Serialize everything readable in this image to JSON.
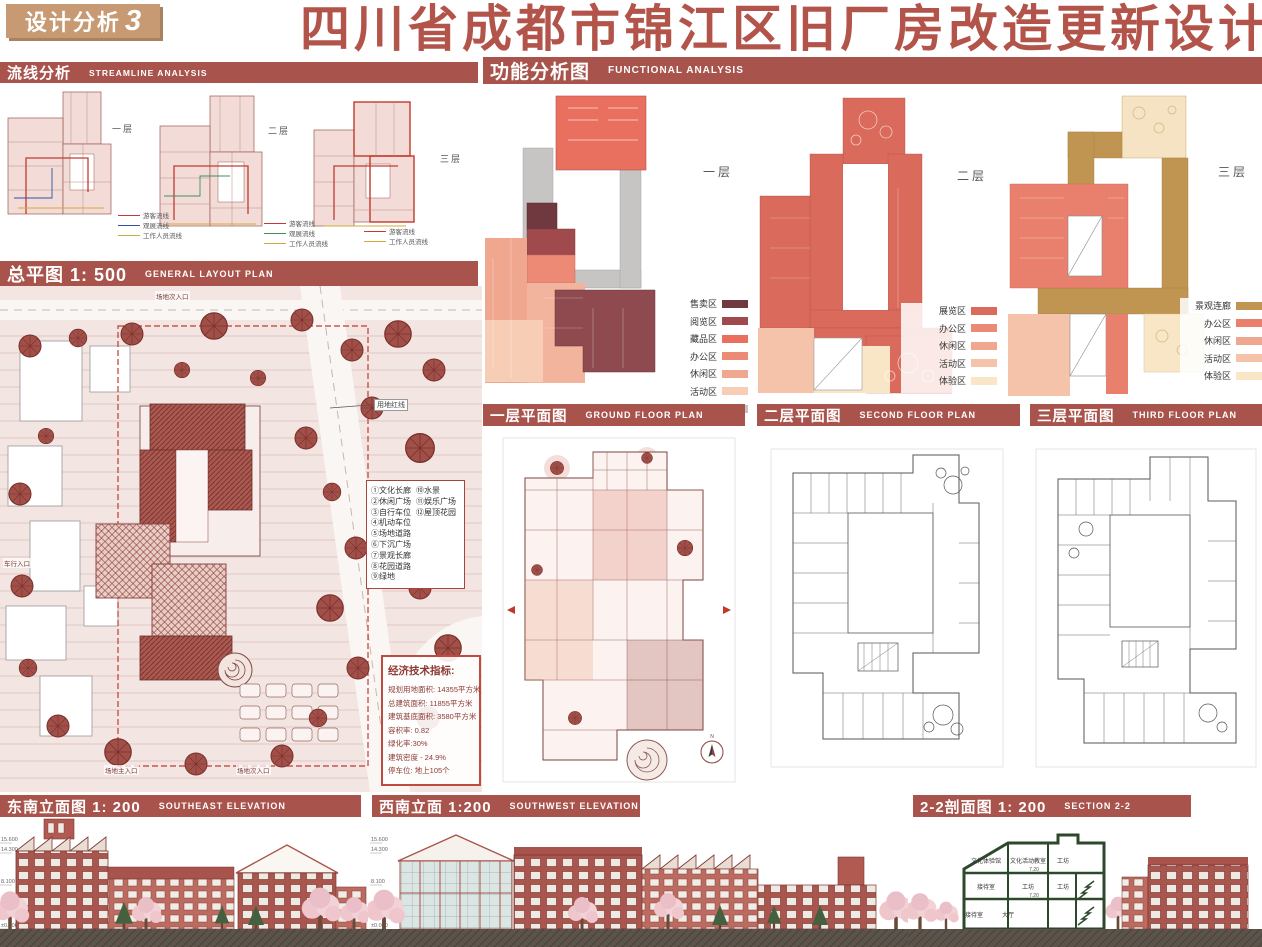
{
  "header": {
    "badge_text": "设计分析",
    "badge_number": "3",
    "title": "四川省成都市锦江区旧厂房改造更新设计"
  },
  "streamline": {
    "title": "流线分析",
    "subtitle": "STREAMLINE ANALYSIS",
    "plans": [
      {
        "floor": "一层",
        "legend": [
          {
            "label": "游客流线",
            "color": "#c23b32"
          },
          {
            "label": "观展流线",
            "color": "#33519e"
          },
          {
            "label": "工作人员流线",
            "color": "#d4a93c"
          }
        ]
      },
      {
        "floor": "二层",
        "legend": [
          {
            "label": "游客流线",
            "color": "#c23b32"
          },
          {
            "label": "观展流线",
            "color": "#3f8f5f"
          },
          {
            "label": "工作人员流线",
            "color": "#d4a93c"
          }
        ]
      },
      {
        "floor": "三层",
        "legend": [
          {
            "label": "游客流线",
            "color": "#c23b32"
          },
          {
            "label": "工作人员流线",
            "color": "#d4a93c"
          }
        ]
      }
    ]
  },
  "general_plan": {
    "title": "总平图 1: 500",
    "subtitle": "GENERAL LAYOUT PLAN",
    "boundary_label": "用地红线",
    "north_label": "N",
    "legend_left": [
      "①文化长廊",
      "②休闲广场",
      "③自行车位",
      "④机动车位",
      "⑤场地道路",
      "⑥下沉广场",
      "⑦景观长廊",
      "⑧花园道路",
      "⑨绿地"
    ],
    "legend_right": [
      "⑩水景",
      "⑪娱乐广场",
      "⑫屋顶花园"
    ],
    "entrances": [
      "场地次入口",
      "车行入口",
      "场地主入口",
      "场地次入口"
    ],
    "indicators": {
      "title": "经济技术指标:",
      "rows": [
        "规划用地面积: 14355平方米",
        "总建筑面积: 11855平方米",
        "建筑基底面积: 3580平方米",
        "容积率: 0.82",
        "绿化率:30%",
        "建筑密度 - 24.9%",
        "停车位: 地上105个"
      ]
    }
  },
  "functional": {
    "title": "功能分析图",
    "subtitle": "FUNCTIONAL ANALYSIS",
    "plans": [
      {
        "floor": "一层",
        "legend": [
          {
            "label": "售卖区",
            "color": "#70383f"
          },
          {
            "label": "阅览区",
            "color": "#a04a4d"
          },
          {
            "label": "藏品区",
            "color": "#e96f5f"
          },
          {
            "label": "办公区",
            "color": "#ec8a76"
          },
          {
            "label": "休闲区",
            "color": "#f0a78f"
          },
          {
            "label": "活动区",
            "color": "#f8cdb6"
          },
          {
            "label": "架空区",
            "color": "#c4c4c4"
          }
        ]
      },
      {
        "floor": "二层",
        "legend": [
          {
            "label": "展览区",
            "color": "#d96a5c"
          },
          {
            "label": "办公区",
            "color": "#ea8a76"
          },
          {
            "label": "休闲区",
            "color": "#efa78f"
          },
          {
            "label": "活动区",
            "color": "#f4c3aa"
          },
          {
            "label": "体验区",
            "color": "#f9e6c6"
          }
        ]
      },
      {
        "floor": "三层",
        "legend": [
          {
            "label": "景观连廊",
            "color": "#c09552"
          },
          {
            "label": "办公区",
            "color": "#e9806e"
          },
          {
            "label": "休闲区",
            "color": "#efa78f"
          },
          {
            "label": "活动区",
            "color": "#f4c3aa"
          },
          {
            "label": "体验区",
            "color": "#f9e6c6"
          }
        ]
      }
    ]
  },
  "floor_plans": [
    {
      "title": "一层平面图",
      "subtitle": "GROUND FLOOR PLAN"
    },
    {
      "title": "二层平面图",
      "subtitle": "SECOND FLOOR PLAN"
    },
    {
      "title": "三层平面图",
      "subtitle": "THIRD FLOOR PLAN"
    }
  ],
  "bottom": {
    "southeast": {
      "title": "东南立面图 1: 200",
      "subtitle": "SOUTHEAST ELEVATION"
    },
    "southwest": {
      "title": "西南立面 1:200",
      "subtitle": "SOUTHWEST ELEVATION"
    },
    "section": {
      "title": "2-2剖面图 1: 200",
      "subtitle": "SECTION 2-2",
      "rooms": [
        "文化体验馆",
        "文化活动教室",
        "工坊",
        "接待室",
        "大厅"
      ],
      "levels": [
        "7.20"
      ]
    },
    "elevation_marks": [
      "15.600",
      "14.300",
      "8.100",
      "4.500",
      "±0.000"
    ]
  }
}
